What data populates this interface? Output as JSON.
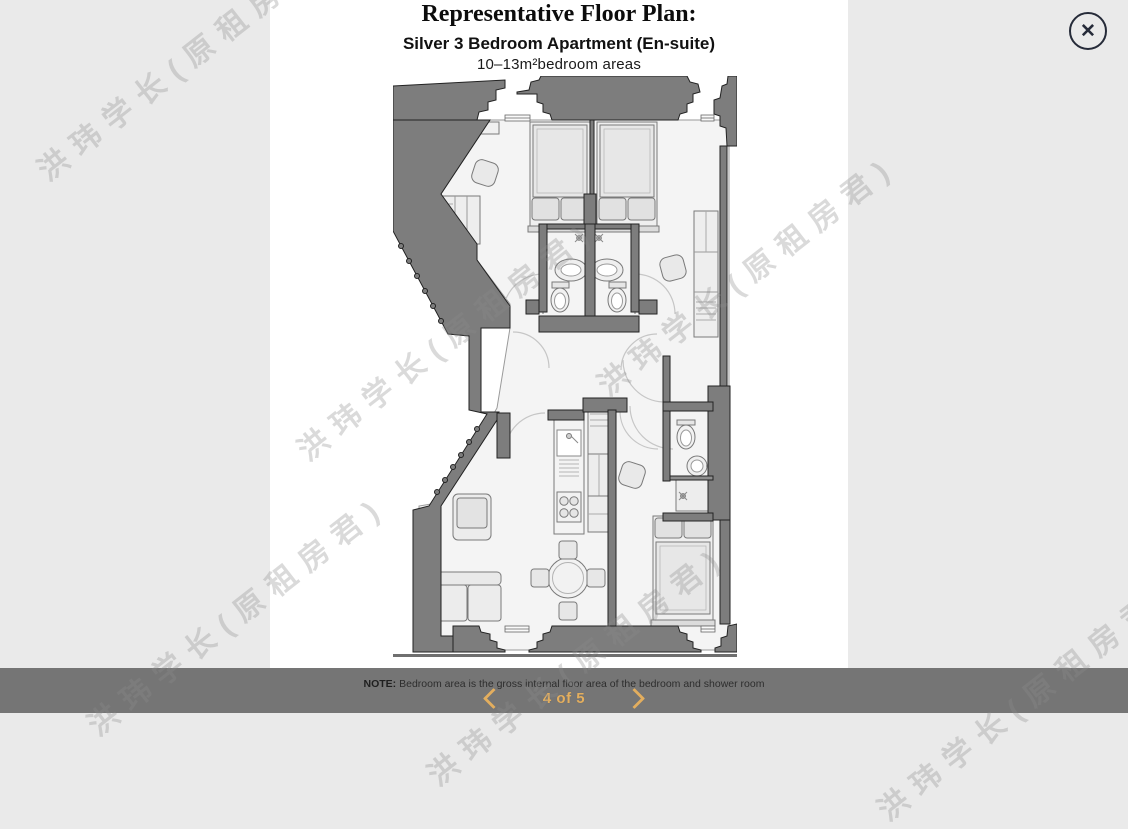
{
  "lightbox": {
    "close_icon": "✕",
    "note_prefix": "NOTE:",
    "note_text": " Bedroom area is the gross internal floor area of the bedroom and shower room",
    "pagination": {
      "current": "4",
      "total": "5",
      "label": "4 of 5"
    }
  },
  "floorplan": {
    "title": "Representative Floor Plan:",
    "subtitle": "Silver 3 Bedroom Apartment (En-suite)",
    "area_line": "10–13m²bedroom areas"
  },
  "watermark": {
    "text": "洪玮学长(原租房君)"
  },
  "colors": {
    "accent_gold": "#E3AE5E",
    "bar_gray": "#757575",
    "wall_gray": "#7D7D7D",
    "page_bg": "#EAEAEA",
    "panel_bg": "#FFFFFF",
    "close_icon_color": "#262B39"
  }
}
